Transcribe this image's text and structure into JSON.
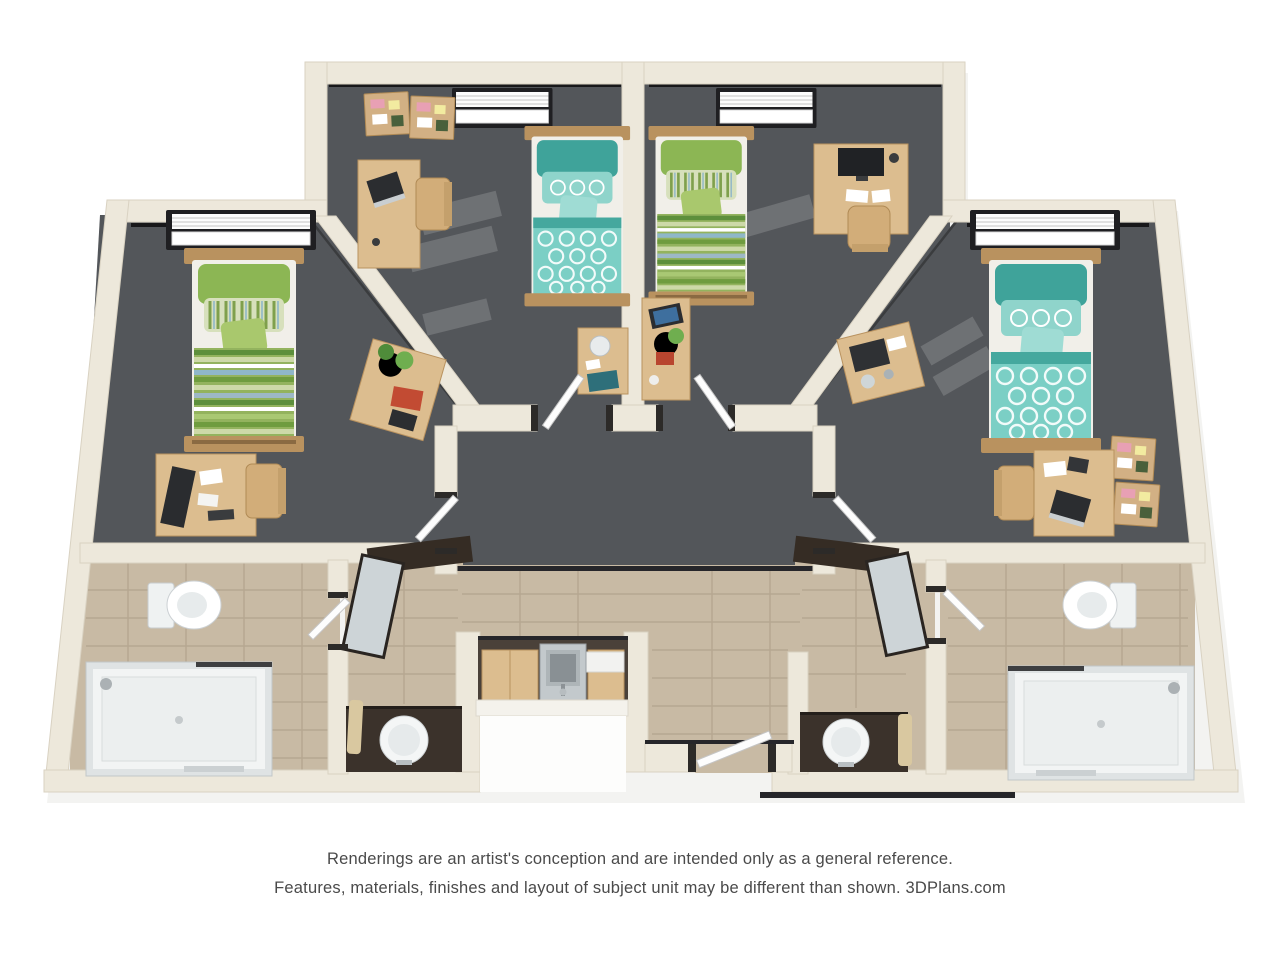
{
  "disclaimer": {
    "line1": "Renderings are an artist's conception and are intended only as a general reference.",
    "line2": "Features, materials, finishes and layout of subject unit may be different than shown. 3DPlans.com",
    "brand": "3DPlans.com"
  },
  "floor_plan": {
    "description": "3D top-down rendering of a four-bedroom student apartment unit",
    "bedrooms": [
      {
        "position": "left",
        "bedding": "green striped",
        "furniture": [
          "twin bed",
          "window with blinds",
          "desk with monitor and papers",
          "desk chair",
          "side table with plant, red book and tablet"
        ]
      },
      {
        "position": "center-left",
        "bedding": "teal patterned",
        "furniture": [
          "twin bed",
          "window with blinds",
          "two corkboards",
          "desk with laptop",
          "desk chair",
          "nightstand with kettle, phone and book"
        ]
      },
      {
        "position": "center-right",
        "bedding": "green striped",
        "furniture": [
          "twin bed",
          "window with blinds",
          "desk with monitor",
          "desk chair",
          "side table with tablet and potted plant"
        ]
      },
      {
        "position": "right",
        "bedding": "teal patterned",
        "furniture": [
          "twin bed",
          "window with blinds",
          "two corkboards",
          "desk with laptop",
          "desk chair",
          "side table with printer"
        ]
      }
    ],
    "bathrooms": [
      {
        "position": "left",
        "fixtures": [
          "toilet",
          "walk-in shower"
        ]
      },
      {
        "position": "right",
        "fixtures": [
          "toilet",
          "walk-in shower"
        ]
      }
    ],
    "vanities": [
      {
        "position": "left",
        "fixtures": [
          "round sink",
          "dark counter",
          "mirror",
          "towel",
          "shelf"
        ]
      },
      {
        "position": "right",
        "fixtures": [
          "round sink",
          "dark counter",
          "mirror",
          "towel",
          "shelf"
        ]
      }
    ],
    "kitchenette": {
      "fixtures": [
        "stainless sink",
        "wood cabinets",
        "white counter",
        "appliance"
      ]
    },
    "hallway": {
      "doors": [
        "bedroom-center-left",
        "bedroom-center-right",
        "bedroom-left",
        "bedroom-right"
      ]
    },
    "entry": {
      "feature": "open entry door at bottom center with dark threshold"
    }
  },
  "colors": {
    "wall": "#EDE8DB",
    "walledge": "#D9D2C2",
    "carpet": "#53565A",
    "tile": "#C8BAA4",
    "grout": "#A3947E",
    "wood": "#DCBD8F",
    "wooddark": "#B9925F",
    "counter": "#3B322B",
    "frame": "#26262A",
    "tealbed": "#7BCFC5",
    "tealpillow": "#3FA39A",
    "greenbed": "#93B35E",
    "greendark": "#5D8F3C",
    "bluestripe": "#8FB7C9",
    "plant": "#5E9C43",
    "accent": "#C24B33",
    "text": "#4A4A4A"
  }
}
